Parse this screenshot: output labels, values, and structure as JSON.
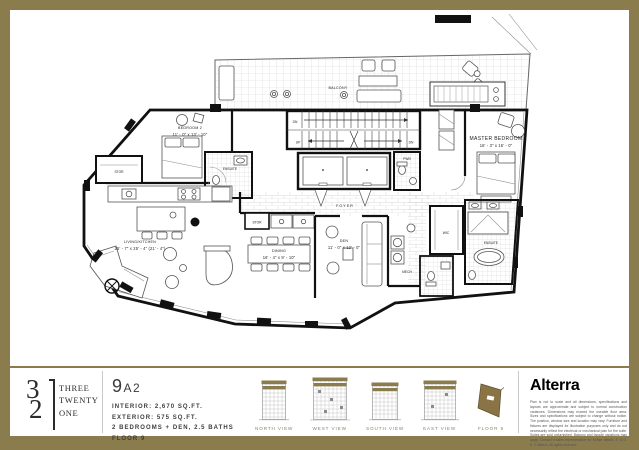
{
  "colors": {
    "accent_gold": "#8b7c4e",
    "floorplate_gold": "#8a7344"
  },
  "plan": {
    "labels": {
      "balcony": "BALCONY",
      "bedroom2": "BEDROOM 2",
      "bedroom2_dims": "11' - 0\" x 13' - 10\"",
      "stor_left": "STOR",
      "ensuite_bed2": "ENSUITE",
      "living_kitchen": "LIVING/KITCHEN",
      "living_kitchen_dims": "25' - 7\" x 25' - 4\" (21' - 4\")",
      "dining": "DINING",
      "dining_dims": "16' - 4\" x 9' - 10\"",
      "stor_center": "STOR",
      "den": "DEN",
      "den_dims": "11' - 0\" x 12' - 0\"",
      "foyer": "FOYER",
      "pwd": "PWD",
      "mech": "MECH",
      "wic": "WIC",
      "master_bedroom": "MASTER BEDROOM",
      "master_bedroom_dims": "16' - 3\" x 16' - 0\"",
      "ensuite_master": "ENSUITE",
      "stair_dn_upper": "DN",
      "stair_up": "UP",
      "stair_dn_lower": "DN"
    }
  },
  "footer": {
    "logo": {
      "number": "321",
      "digit_top": "3",
      "digit_bottom": "2",
      "word1": "THREE",
      "word2": "TWENTY",
      "word3": "ONE"
    },
    "unit": {
      "name": "9A2",
      "interior": "INTERIOR: 2,670 SQ.FT.",
      "exterior": "EXTERIOR: 575 SQ.FT.",
      "rooms": "2 BEDROOMS + DEN, 2.5 BATHS",
      "floor": "FLOOR 9"
    },
    "views": [
      {
        "label": "NORTH VIEW"
      },
      {
        "label": "WEST VIEW"
      },
      {
        "label": "SOUTH VIEW"
      },
      {
        "label": "EAST VIEW"
      },
      {
        "label": "FLOOR 9"
      }
    ],
    "brand": {
      "name": "Alterra",
      "disclaimer": "Plan is not to scale and all dimensions, specifications and layouts are approximate and subject to normal construction variances. Dimensions may exceed the useable floor area. Sizes and specifications are subject to change without notice. The position, window size and location may vary. Furniture and fixtures are displayed for illustration purposes only and do not necessarily reflect the electrical or mechanical plan for the suite. Suites are sold unfurnished. Balcony and facade variations may apply. Contact a sales representative for further details. E. & O. E. © Alterra. All rights reserved."
    }
  }
}
